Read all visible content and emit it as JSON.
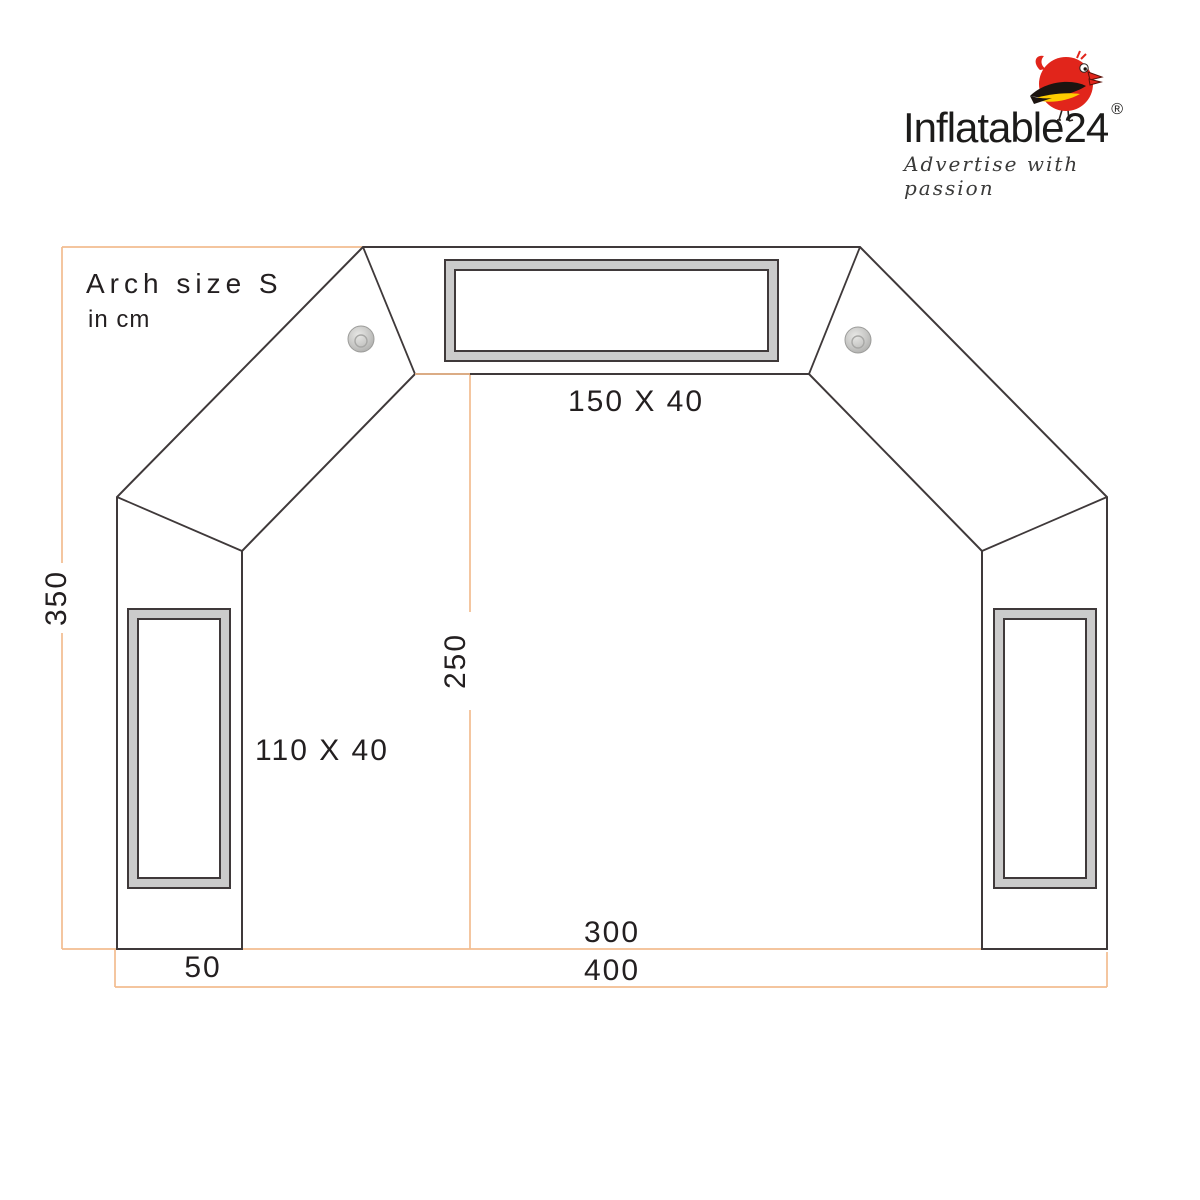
{
  "logo": {
    "brand": "Inflatable24",
    "registered": "®",
    "tagline": "Advertise with passion"
  },
  "title": {
    "heading": "Arch size S",
    "unit_note": "in cm"
  },
  "dimensions": {
    "total_height": "350",
    "inner_height": "250",
    "total_width": "400",
    "inner_width": "300",
    "leg_width": "50",
    "top_banner_size": "150 X 40",
    "side_banner_size": "110 X 40"
  },
  "colors": {
    "dimension_line": "#f2bd90",
    "outline": "#3f393a",
    "banner_frame_fill": "#cbcbcb",
    "grommet_gray": "#bdbdbd",
    "logo_red": "#e1251b",
    "logo_yellow": "#ffcc00",
    "text": "#231f20"
  }
}
